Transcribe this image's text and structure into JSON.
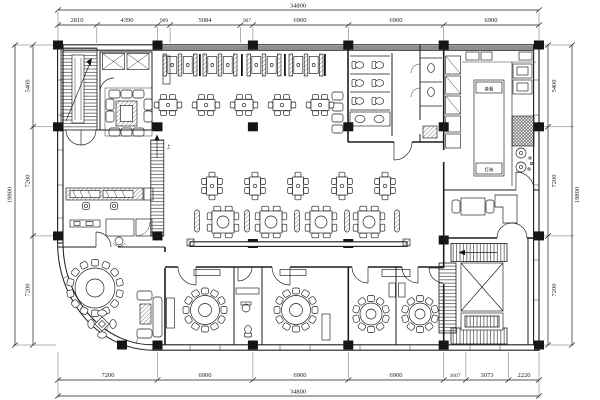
{
  "drawing": {
    "kind": "restaurant floor plan (CAD)",
    "background": "#ffffff",
    "line_color": "#1c1c1c",
    "wall_poche_color": "#8e8e8e"
  },
  "dimensions": {
    "top": {
      "overall": "34800",
      "segments": [
        "2810",
        "4390",
        "909",
        "5084",
        "907",
        "6900",
        "6900",
        "6900"
      ]
    },
    "bottom": {
      "overall": "34800",
      "segments": [
        "7200",
        "6900",
        "6900",
        "6900",
        "1607",
        "3073",
        "2220"
      ]
    },
    "left": {
      "overall": "19800",
      "segments": [
        "5400",
        "7200",
        "7200"
      ]
    },
    "right": {
      "overall": "19800",
      "segments": [
        "5400",
        "7200",
        "7200"
      ]
    }
  },
  "annotations": {
    "kitchen_prep": "备餐",
    "kitchen_pass": "打荷",
    "stair_up": "上"
  }
}
